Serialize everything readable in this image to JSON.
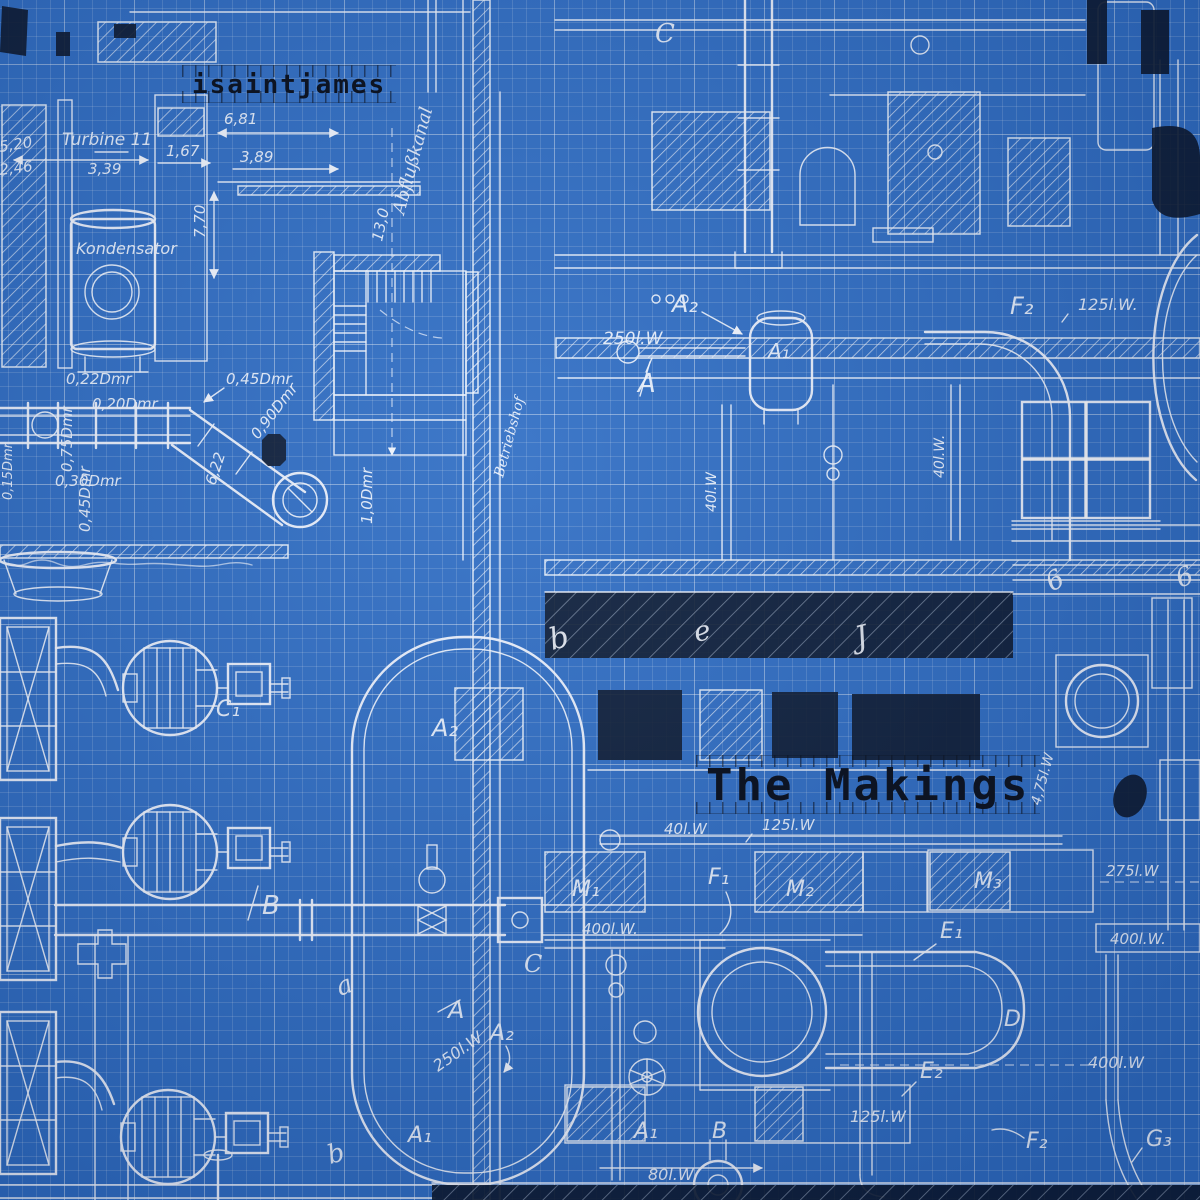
{
  "artist": "isaintjames",
  "album_title": "The Makings",
  "colors": {
    "background_blue": "#2e6dc4",
    "grid_minor": "rgba(255,255,255,0.14)",
    "grid_major": "rgba(255,255,255,0.30)",
    "drawing_line": "#f2f7ff",
    "dark_ink": "#0b1930",
    "title_ink": "#0d1423"
  },
  "labels": {
    "turbine": "Turbine 11",
    "kondensator": "Kondensator",
    "abflusskanal": "Abflußkanal",
    "betriebshof": "Betriebshof",
    "dim_5_20": "5,20",
    "dim_2_46": "2,46",
    "dim_3_39": "3,39",
    "dim_1_67": "1,67",
    "dim_6_81": "6,81",
    "dim_3_89": "3,89",
    "dim_7_70": "7,70",
    "dim_13_0": "13,0",
    "dmr_0_22": "0,22Dmr",
    "dmr_0_20": "0,20Dmr",
    "dmr_0_45a": "0,45Dmr",
    "dmr_0_75": "0,75Dmr",
    "dmr_0_90": "0,90Dmr",
    "dmr_0_30": "0,30Dmr",
    "dmr_0_45b": "0,45Dmr",
    "dmr_0_15": "0,15Dmr",
    "dim_6_22": "6,22",
    "dmr_1_0": "1,0Dmr",
    "tag_c_top": "C",
    "tag_a2_top": "A₂",
    "flow_250_top": "250l.W",
    "tag_a1_top": "A₁",
    "tag_a_top": "A",
    "tag_f2_top": "F₂",
    "flow_125_top": "125l.W.",
    "flow_40_v1": "40l.W",
    "flow_40_v2": "40l.W.",
    "tag_c1": "C₁",
    "tag_b_left": "B",
    "tag_a2_mid": "A₂",
    "letter_a_rot": "a",
    "letter_b_rot": "b",
    "band_letter_b": "b",
    "band_letter_e": "e",
    "band_letter_j": "J",
    "band_digit_6a": "6",
    "band_digit_6b": "6",
    "flow_40_bottom": "40l.W",
    "flow_125_mid": "125l.W",
    "tag_m1": "M₁",
    "tag_f1": "F₁",
    "tag_m2": "M₂",
    "tag_m3": "M₃",
    "flow_400_left": "400l.W.",
    "tag_e1": "E₁",
    "tag_d": "D",
    "tag_e2": "E₂",
    "flow_125_bottom": "125l.W",
    "tag_f2_bottom": "F₂",
    "tag_g3": "G₃",
    "flow_400_box": "400l.W.",
    "flow_400_right": "400l.W",
    "flow_275": "275l.W",
    "flow_4_75": "4,75l.W",
    "tag_a_mid": "A",
    "tag_a2_bottom": "A₂",
    "flow_250_bottom": "250l.W",
    "tag_a1_bottom_left": "A₁",
    "tag_a1_bottom": "A₁",
    "tag_b_bottom": "B",
    "flow_80": "80l.W",
    "tag_c_cursive": "C"
  }
}
